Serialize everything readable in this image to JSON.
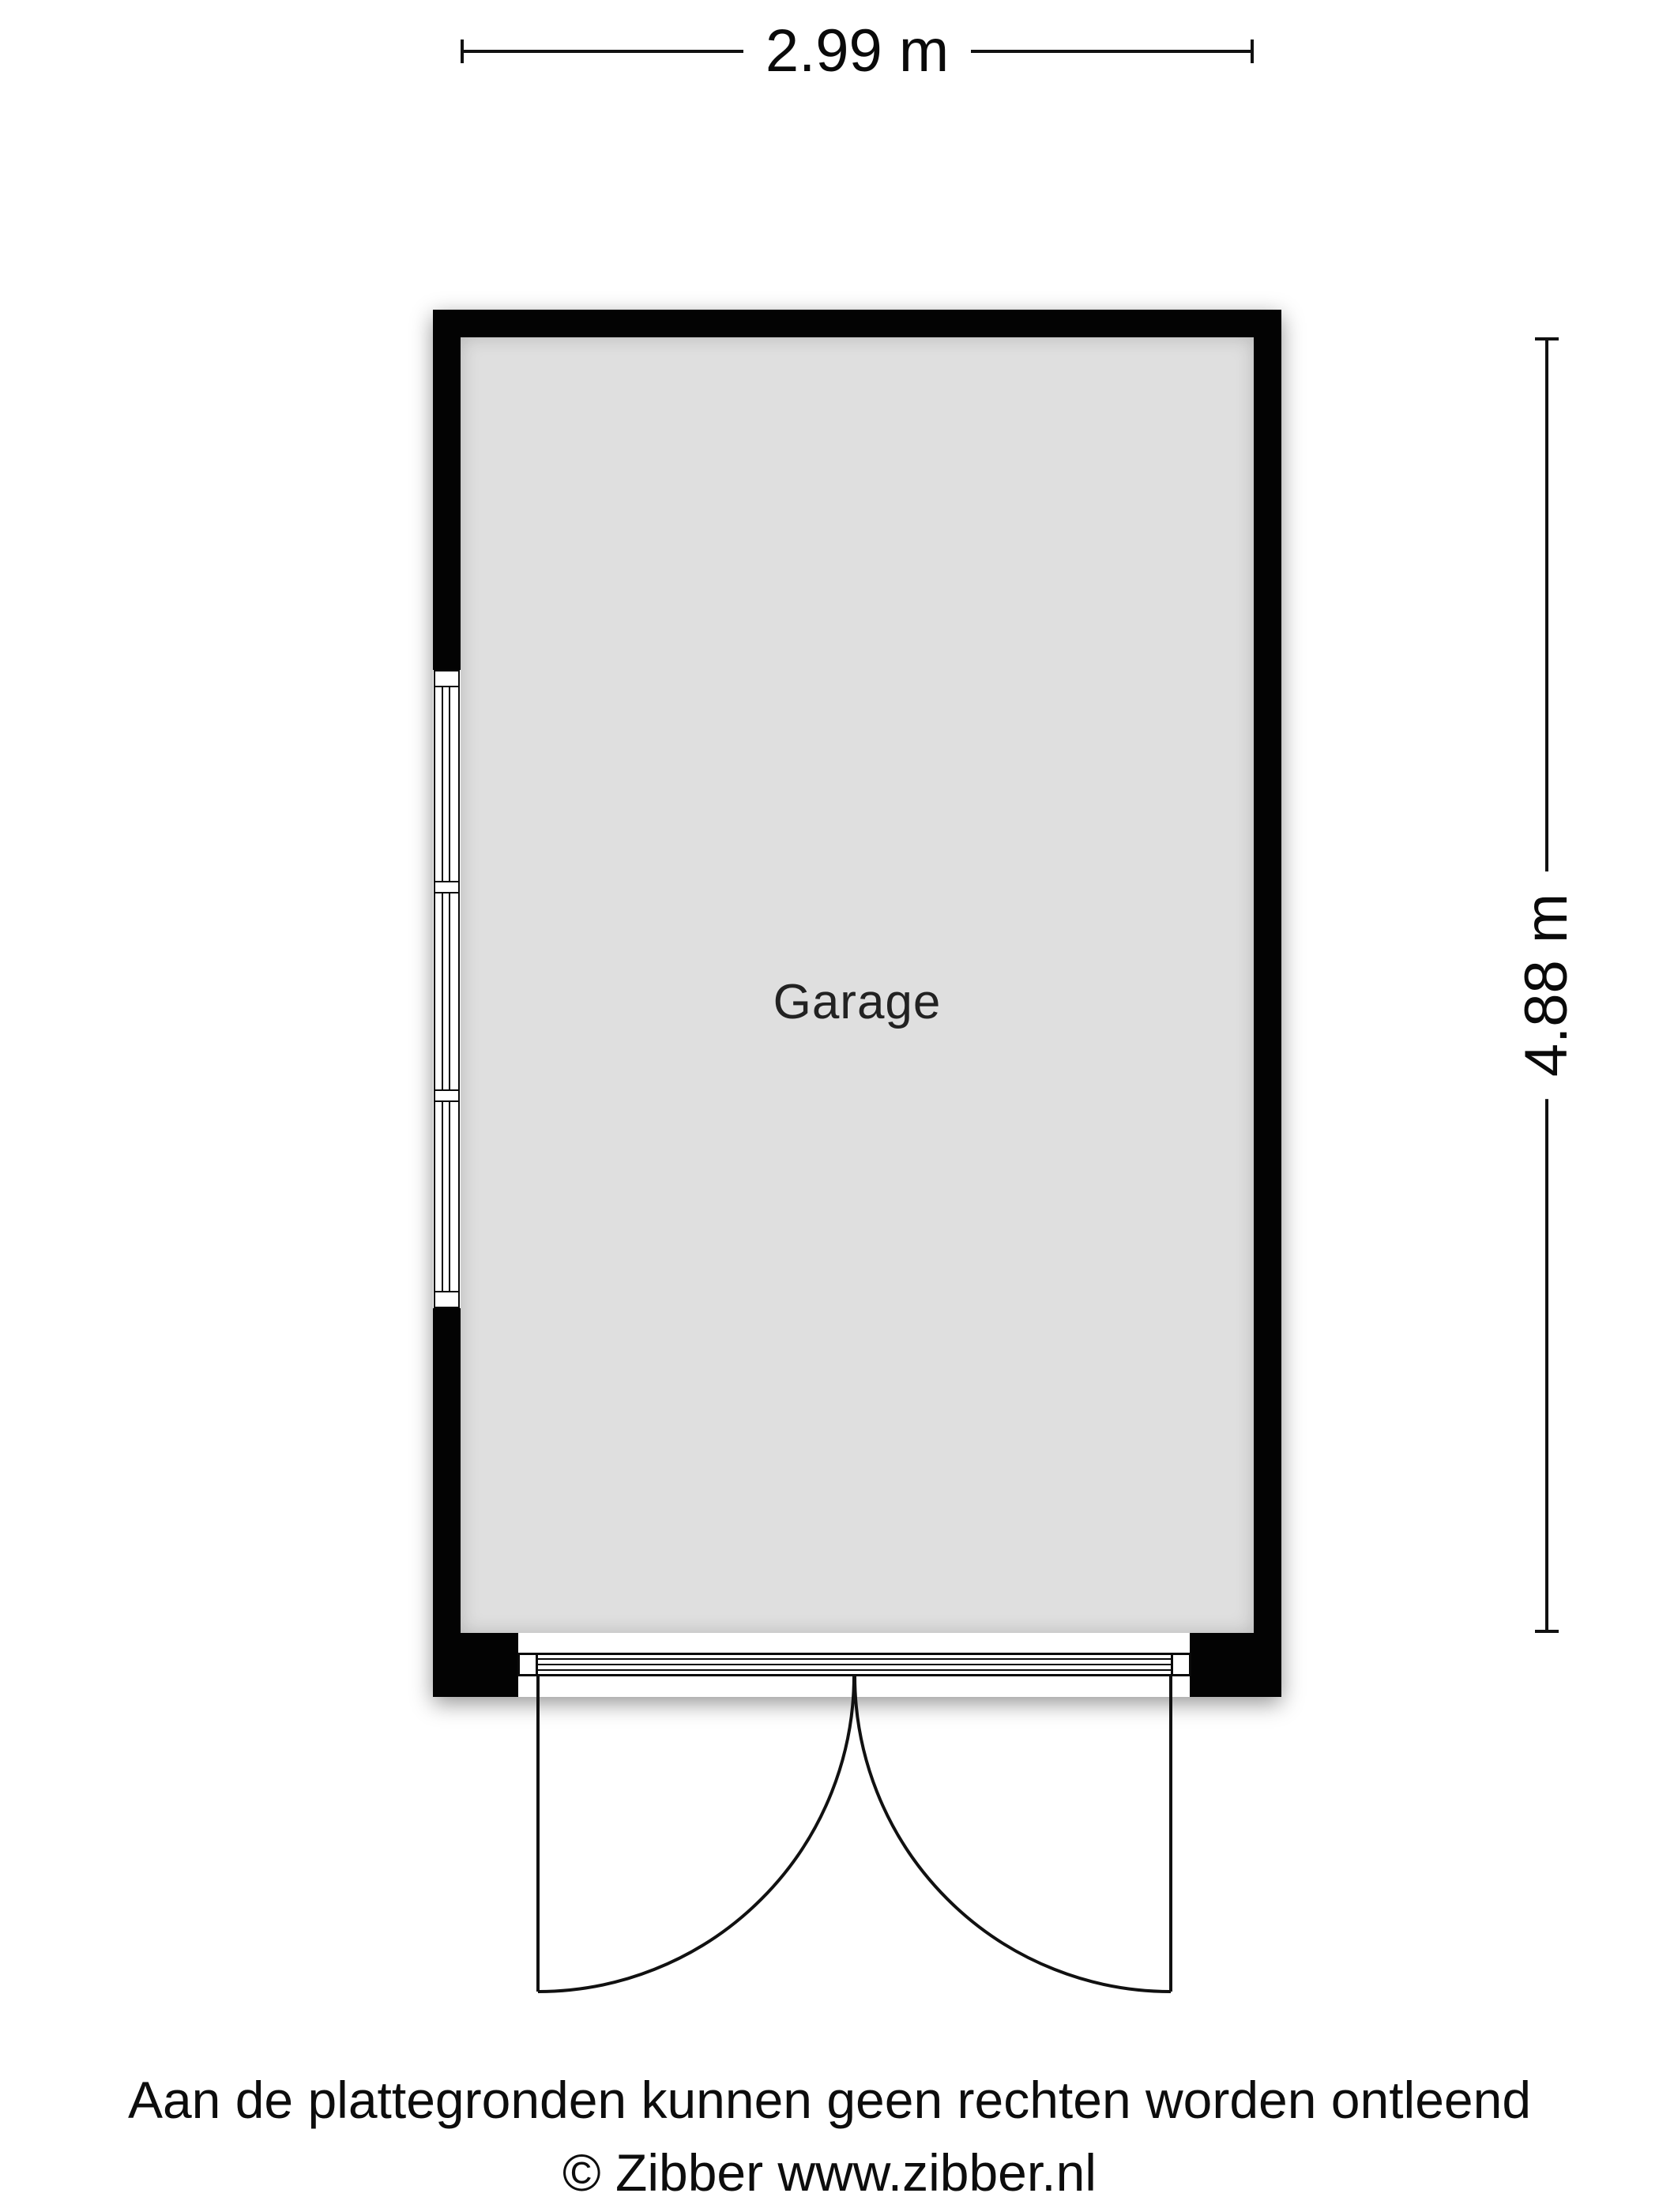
{
  "dimensions": {
    "width": "2.99 m",
    "height": "4.88 m"
  },
  "room": {
    "label": "Garage"
  },
  "footer": {
    "disclaimer": "Aan de plattegronden kunnen geen rechten worden ontleend",
    "copyright": "© Zibber www.zibber.nl"
  },
  "colors": {
    "wall": "#030303",
    "floor": "#dfdfdf",
    "line": "#111111",
    "background": "#ffffff"
  }
}
